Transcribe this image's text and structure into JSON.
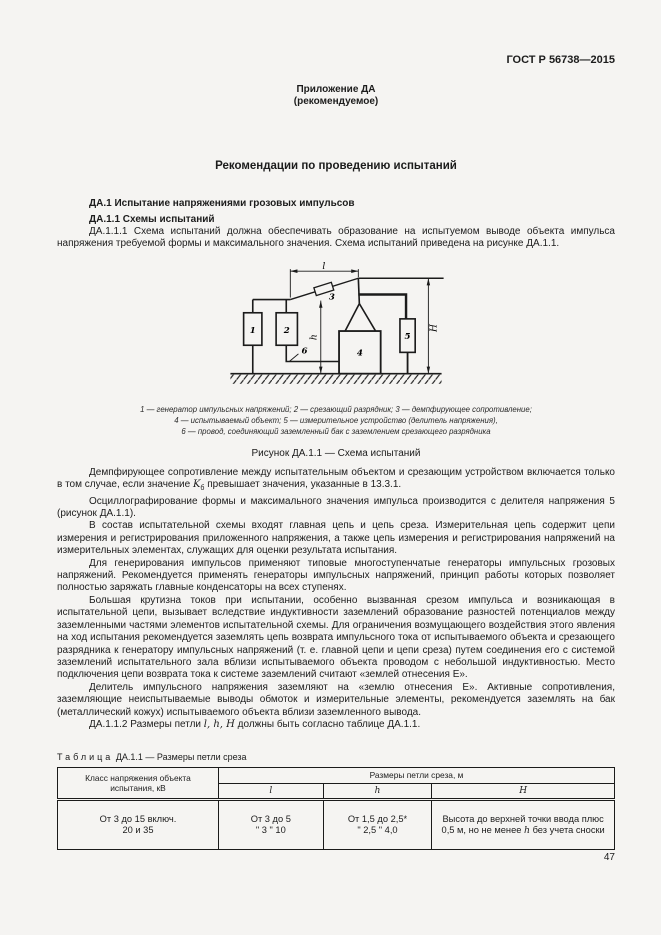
{
  "header": {
    "doc_code": "ГОСТ Р 56738—2015",
    "annex": "Приложение ДА",
    "annex_note": "(рекомендуемое)"
  },
  "title": "Рекомендации по проведению испытаний",
  "sections": {
    "h1": "ДА.1 Испытание напряжениями грозовых импульсов",
    "h2": "ДА.1.1 Схемы испытаний"
  },
  "paragraphs": {
    "p1": "ДА.1.1.1 Схема испытаний должна обеспечивать образование на испытуемом выводе объекта импульса напряжения требуемой формы и максимального значения. Схема испытаний приведена на рисунке ДА.1.1.",
    "p2": {
      "pre": "Демпфирующее сопротивление между испытательным объектом и срезающим устройством включается только в том случае, если значение ",
      "var": "K",
      "sub": "б",
      "post": " превышает значения, указанные в 13.3.1."
    },
    "p3": "Осциллографирование формы и максимального значения импульса производится с делителя напряжения 5 (рисунок ДА.1.1).",
    "p4": "В состав испытательной схемы входят главная цепь и цепь среза. Измерительная цепь содержит цепи измерения и регистрирования приложенного напряжения, а также цепь измерения и регистрирования напряжений на измерительных элементах, служащих для оценки результата испытания.",
    "p5": "Для генерирования импульсов применяют типовые многоступенчатые генераторы импульсных грозовых напряжений. Рекомендуется применять генераторы импульсных напряжений, принцип работы которых позволяет полностью заряжать главные конденсаторы на всех ступенях.",
    "p6": "Большая крутизна токов при испытании, особенно вызванная срезом импульса и возникающая в испытательной цепи, вызывает вследствие индуктивности заземлений образование разностей потенциалов между заземленными частями элементов испытательной схемы. Для ограничения возмущающего воздействия этого явления на ход испытания рекомендуется заземлять цепь возврата импульсного тока от испытываемого объекта и срезающего разрядника к генератору импульсных напряжений (т. е. главной цепи и цепи среза) путем соединения его с системой заземлений испытательного зала вблизи испытываемого объекта проводом с небольшой индуктивностью. Место подключения цепи возврата тока к системе заземлений считают «землей отнесения Е».",
    "p7": "Делитель импульсного напряжения заземляют на «землю отнесения Е». Активные сопротивления, заземляющие неиспытываемые выводы обмоток и измерительные элементы, рекомендуется заземлять на бак (металлический кожух) испытываемого объекта вблизи заземленного вывода.",
    "p8": {
      "pre": "ДА.1.1.2 Размеры петли ",
      "vars": "l, h, Н",
      "post": " должны быть согласно таблице ДА.1.1."
    }
  },
  "figure": {
    "labels": {
      "box1": "1",
      "box2": "2",
      "item3": "3",
      "box4": "4",
      "box5": "5",
      "wire6": "6",
      "dim_l": "l",
      "dim_h": "h",
      "dim_H": "H"
    },
    "legend_lines": [
      "1 — генератор импульсных напряжений; 2 — срезающий разрядник; 3 — демпфирующее сопротивление;",
      "4 — испытываемый объект; 5 — измерительное устройство (делитель напряжения),",
      "6 — провод, соединяющий заземленный бак с заземлением срезающего разрядника"
    ],
    "caption": "Рисунок ДА.1.1 — Схема испытаний"
  },
  "table": {
    "label_word": "Таблица",
    "label_rest": "ДА.1.1 — Размеры петли среза",
    "col1_header": "Класс напряжения объекта испытания, кВ",
    "group_header": "Размеры петли среза, м",
    "sub_headers": [
      "l",
      "h",
      "H"
    ],
    "row": {
      "c1": [
        "От 3 до 15 включ.",
        "20 и 35"
      ],
      "c2": [
        "От 3 до 5",
        "\" 3 \" 10"
      ],
      "c3": [
        "От 1,5 до 2,5*",
        "\" 2,5 \" 4,0"
      ],
      "c4_pre": "Высота до верхней точки ввода плюс 0,5 м, но не менее ",
      "c4_var": "h",
      "c4_post": " без учета сноски"
    }
  },
  "page": {
    "number": "47"
  },
  "colors": {
    "page_bg": "#f5f4f2",
    "text": "#1c1c1c",
    "line": "#1b1b1b"
  }
}
